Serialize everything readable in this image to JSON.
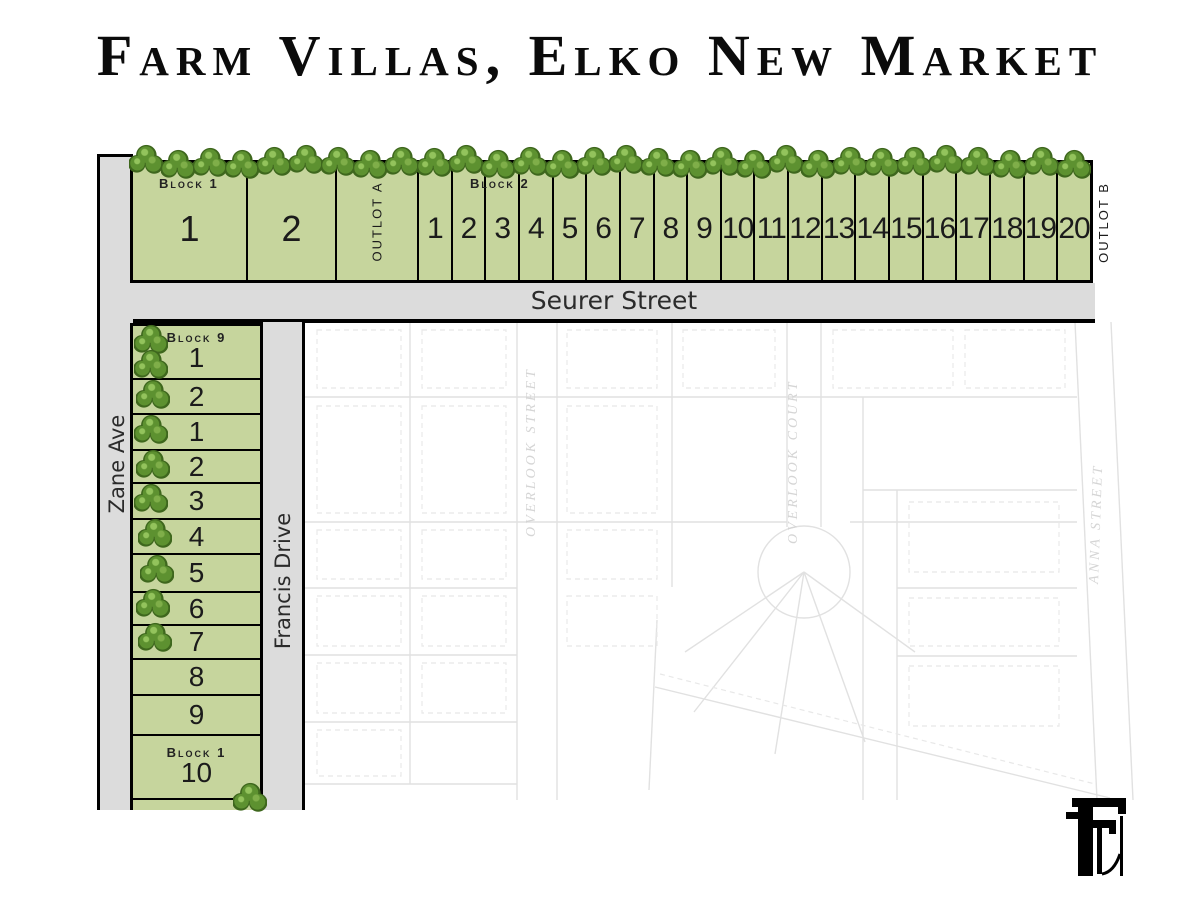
{
  "title": "Farm Villas, Elko New Market",
  "streets": {
    "seurer": "Seurer Street",
    "zane": "Zane Ave",
    "francis": "Francis Drive"
  },
  "top_row": {
    "block1_label": "Block 1",
    "block2_label": "Block 2",
    "outlot_a_label": "Outlot A",
    "outlot_b_label": "Outlot B",
    "block1_lots": [
      "1",
      "2"
    ],
    "block2_lots": [
      "1",
      "2",
      "3",
      "4",
      "5",
      "6",
      "7",
      "8",
      "9",
      "10",
      "11",
      "12",
      "13",
      "14",
      "15",
      "16",
      "17",
      "18",
      "19",
      "20"
    ]
  },
  "left_column": {
    "block9_label": "Block 9",
    "block1_label": "Block 1",
    "block9_lots": [
      "1",
      "2"
    ],
    "block1_lots": [
      "1",
      "2",
      "3",
      "4",
      "5",
      "6",
      "7",
      "8",
      "9",
      "10"
    ]
  },
  "background_plat": {
    "street_labels": [
      "Overlook Street",
      "Overlook Court",
      "Anna Street"
    ]
  },
  "decor": {
    "top_tree_count": 30,
    "colors": {
      "lot_green": "#c6d59d",
      "road_gray": "#dcdcdc",
      "tree_dark": "#3e671d",
      "tree_light": "#5d9130",
      "outline_black": "#000000"
    }
  }
}
